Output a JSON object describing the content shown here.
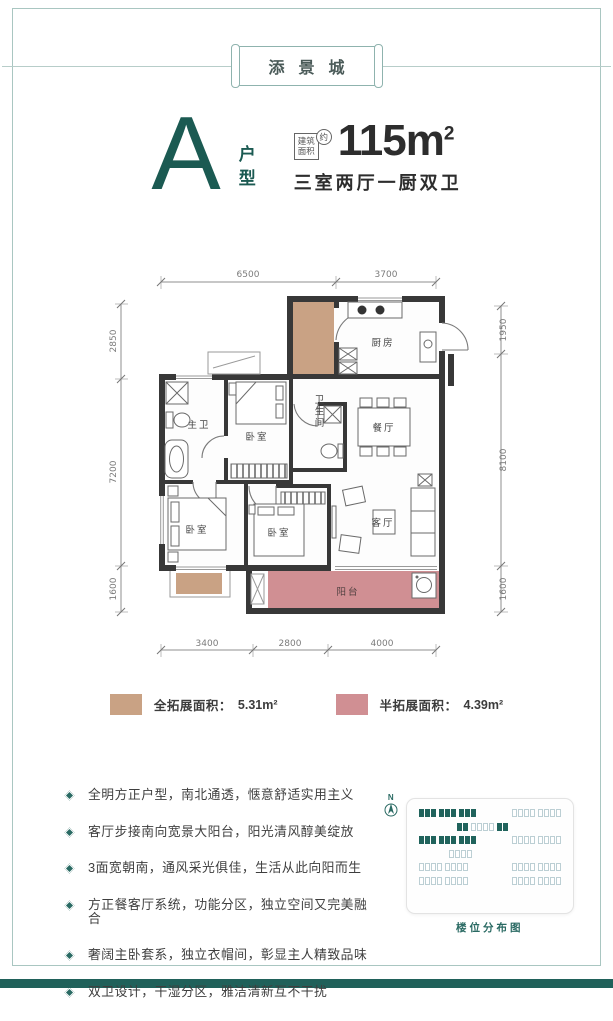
{
  "header": {
    "project_name": "添景城"
  },
  "unit": {
    "letter": "A",
    "type_label": "户型",
    "area_box_line1": "建筑",
    "area_box_line2": "面积",
    "area_approx": "约",
    "area_value": "115m",
    "area_exponent": "2",
    "rooms_desc": "三室两厅一厨双卫"
  },
  "floorplan": {
    "rooms": {
      "kitchen": "厨房",
      "master_bath": "主卫",
      "bedroom_top": "卧室",
      "bath": "卫生间",
      "dining": "餐厅",
      "bedroom_left": "卧室",
      "bedroom_mid": "卧室",
      "living": "客厅",
      "balcony": "阳台"
    },
    "dims": {
      "top": [
        "6500",
        "3700"
      ],
      "left": [
        "2850",
        "7200",
        "1600"
      ],
      "right": [
        "1950",
        "8100",
        "1600"
      ],
      "bottom": [
        "3400",
        "2800",
        "4000"
      ]
    }
  },
  "legend": {
    "full": {
      "label": "全拓展面积：",
      "value": "5.31m²",
      "color": "#c9a284"
    },
    "half": {
      "label": "半拓展面积：",
      "value": "4.39m²",
      "color": "#d08f93"
    }
  },
  "features": [
    "全明方正户型，南北通透，惬意舒适实用主义",
    "客厅步接南向宽景大阳台，阳光清风醇美绽放",
    "3面宽朝南，通风采光俱佳，生活从此向阳而生",
    "方正餐客厅系统，功能分区，独立空间又完美融合",
    "奢阔主卧套系，独立衣帽间，彰显主人精致品味",
    "双卫设计，干湿分区，雅洁清新互不干扰"
  ],
  "sitemap": {
    "north": "N",
    "caption": "楼位分布图"
  },
  "colors": {
    "accent_teal": "#1b5a52",
    "wall": "#383838",
    "full_extend_tan": "#c9a284",
    "half_extend_rose": "#d08f93"
  }
}
